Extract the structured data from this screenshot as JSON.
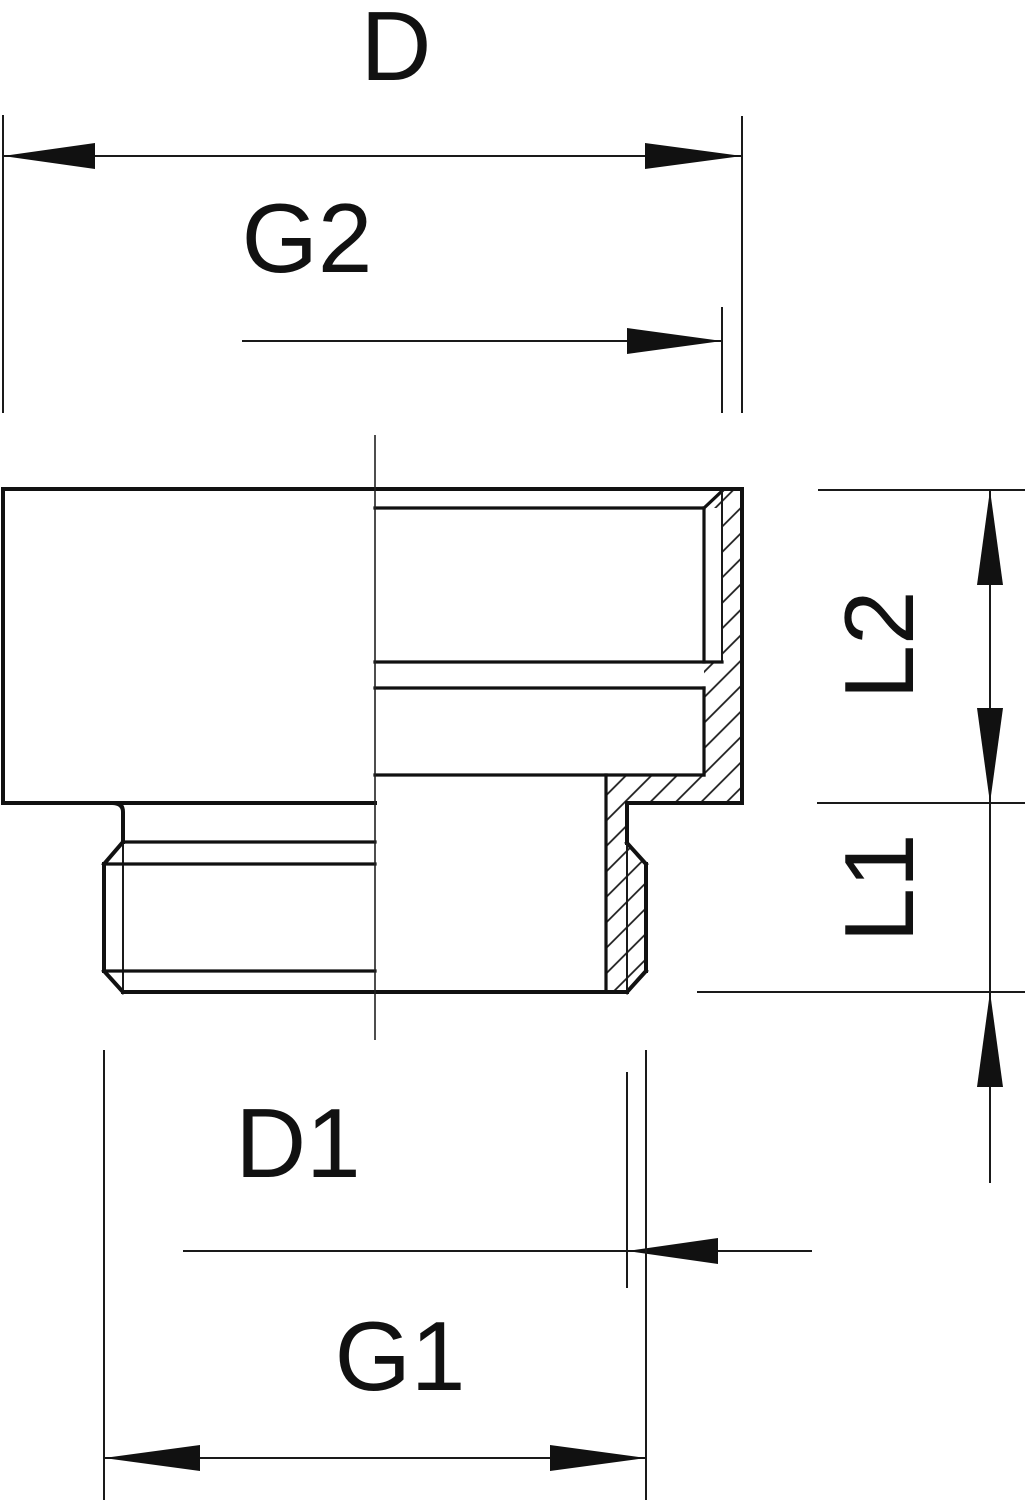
{
  "drawing": {
    "type": "technical-dimension-drawing",
    "subject": "threaded reducer adapter cross-section",
    "background_color": "#ffffff",
    "line_color": "#111111",
    "dimensions": {
      "d": {
        "label": "D"
      },
      "g2": {
        "label": "G2"
      },
      "l2": {
        "label": "L2"
      },
      "l1": {
        "label": "L1"
      },
      "d1": {
        "label": "D1"
      },
      "g1": {
        "label": "G1"
      }
    }
  }
}
